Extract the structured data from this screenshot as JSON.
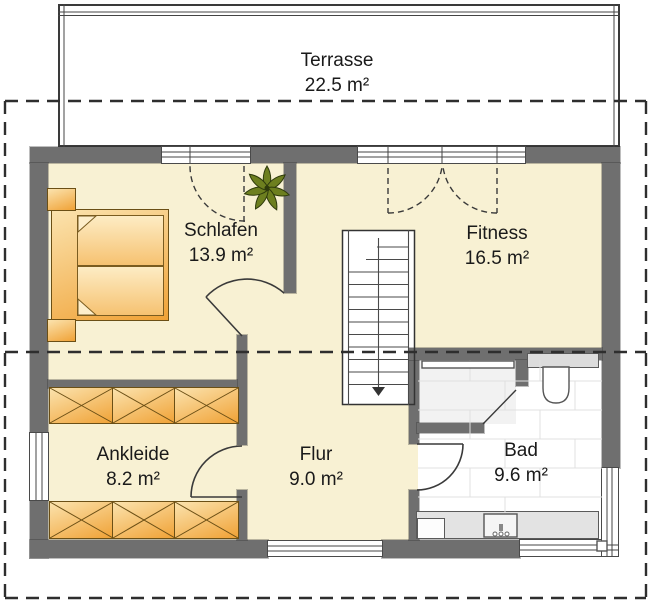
{
  "plan": {
    "title": "floor-plan-upper-storey",
    "rooms": [
      {
        "id": "terrasse",
        "name": "Terrasse",
        "area": "22.5 m²"
      },
      {
        "id": "schlafen",
        "name": "Schlafen",
        "area": "13.9 m²"
      },
      {
        "id": "fitness",
        "name": "Fitness",
        "area": "16.5 m²"
      },
      {
        "id": "ankleide",
        "name": "Ankleide",
        "area": "8.2 m²"
      },
      {
        "id": "flur",
        "name": "Flur",
        "area": "9.0 m²"
      },
      {
        "id": "bad",
        "name": "Bad",
        "area": "9.6 m²"
      }
    ],
    "colors": {
      "floor": "#f8f1d3",
      "wall": "#6f6f6f",
      "furniture_light": "#fbe3ae",
      "furniture_mid": "#f6c271",
      "furniture_dark": "#f0a236",
      "plant": "#6d7f1f",
      "tile_line": "#e0e0e0",
      "fixture_gray": "#e3e3e3"
    }
  }
}
